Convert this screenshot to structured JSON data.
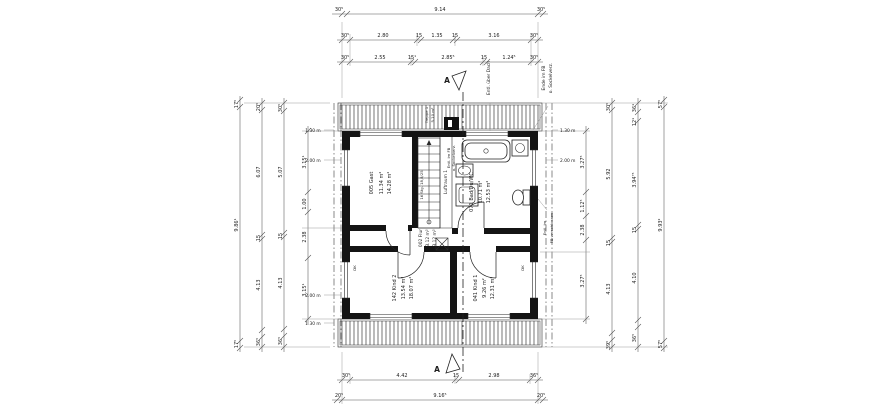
{
  "rooms": {
    "gast": {
      "label": "005 Gast",
      "area_net": "11.34 m²",
      "area_gross": "14.28 m²"
    },
    "bad": {
      "label": "071 Bad/Du/WC",
      "area_net": "10.71 m²",
      "area_gross": "12.53 m²"
    },
    "flur": {
      "label": "002 Flur",
      "area_net": "3.12 m²",
      "area_gross": "3.12 m²"
    },
    "kind2": {
      "label": "142 Kind 2",
      "area_net": "13.54 m²",
      "area_gross": "18.07 m²"
    },
    "kind1": {
      "label": "041 Kind 1",
      "area_net": "9.26 m²",
      "area_gross": "12.31 m²"
    },
    "luftraum": {
      "label": "Luftraum 1"
    },
    "treppe": {
      "label": "Treppe 1",
      "area": "5.10 m²",
      "stairs_note": "16 Stg. 18,8/25"
    }
  },
  "annotations": {
    "section_letter": "A",
    "vent_roof": "Entl. über Dach",
    "corner_note_line1": "Ende im FB",
    "corner_note_line2": "o. Sockelverz.",
    "bath_note_line1": "Entl. im FB",
    "bath_note_line2": "o. Sockelverz.",
    "right_note_line1": "Entl. im",
    "right_note_line2": "FB verschlossen",
    "height_130": "1.30 m",
    "height_200": "2.00 m",
    "window_code": "DK"
  },
  "dims": {
    "top_row1": [
      "30⁵",
      "9.14",
      "30⁵"
    ],
    "top_row2": [
      "30⁵",
      "2.80",
      "15",
      "1.35",
      "15",
      "3.16",
      "30⁵"
    ],
    "top_row3": [
      "30⁵",
      "2.55",
      "15¹",
      "2.85⁵",
      "15",
      "1.24⁵",
      "30⁵"
    ],
    "bottom_row1": [
      "30⁵",
      "4.42",
      "15",
      "2.98",
      "36⁵"
    ],
    "bottom_row2": [
      "20⁵",
      "9.16⁵",
      "20⁵"
    ],
    "left_col1": [
      "17⁵",
      "9.86¹",
      "17⁵"
    ],
    "left_col2": [
      "20⁵",
      "6.07",
      "15",
      "4.13",
      "36⁵"
    ],
    "left_col3": [
      "30⁵",
      "5.07",
      "15",
      "4.13",
      "36⁵"
    ],
    "left_col4": [
      "3.15¹",
      "1.00",
      "2.38",
      "3.15¹"
    ],
    "right_col1": [
      "3.27⁵",
      "1.12⁵",
      "2.38",
      "3.27⁵"
    ],
    "right_col2": [
      "30⁵",
      "5.92",
      "15",
      "4.13",
      "39⁵"
    ],
    "right_col3": [
      "36¹",
      "12¹",
      "3.94⁷⁵",
      "15",
      "4.10",
      "36⁵"
    ],
    "right_col4": [
      "57⁵",
      "9.93²",
      "57⁵"
    ]
  }
}
